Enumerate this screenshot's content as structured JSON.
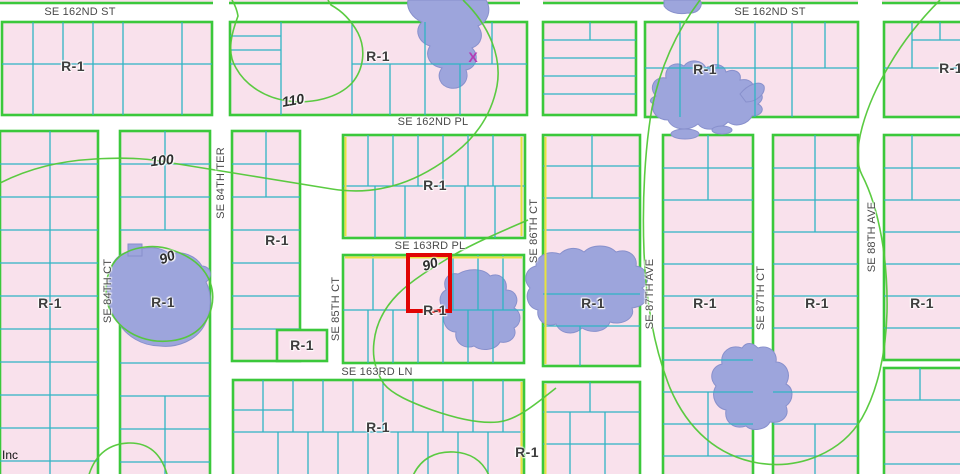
{
  "map": {
    "colors": {
      "parcel_fill": "#f9e1ec",
      "street_fill": "#ffffff",
      "block_border": "#3bc83b",
      "lot_line": "#2fb4c4",
      "contour": "#52c838",
      "water_fill": "#9da5dc",
      "water_edge": "#8890cc",
      "highlight_red": "#e00404",
      "yellow_edge": "#e8e23e",
      "x_mark": "#b43cb4",
      "label_text": "#4a4a4a"
    },
    "street_labels": [
      {
        "text": "SE 162ND ST"
      },
      {
        "text": "SE 162ND ST"
      },
      {
        "text": "SE 162ND PL"
      },
      {
        "text": "SE 163RD PL"
      },
      {
        "text": "SE 163RD LN"
      },
      {
        "text": "SE 84TH CT"
      },
      {
        "text": "SE 84TH TER"
      },
      {
        "text": "SE 85TH CT"
      },
      {
        "text": "SE 86TH CT"
      },
      {
        "text": "SE 87TH AVE"
      },
      {
        "text": "SE 87TH CT"
      },
      {
        "text": "SE 88TH AVE"
      }
    ],
    "zone_labels": [
      {
        "text": "R-1"
      },
      {
        "text": "R-1"
      },
      {
        "text": "R-1"
      },
      {
        "text": "R-1"
      },
      {
        "text": "R-1"
      },
      {
        "text": "R-1"
      },
      {
        "text": "R-1"
      },
      {
        "text": "R-1"
      },
      {
        "text": "R-1"
      },
      {
        "text": "R-1"
      },
      {
        "text": "R-1"
      },
      {
        "text": "R-1"
      },
      {
        "text": "R-1"
      },
      {
        "text": "R-1"
      },
      {
        "text": "R-1"
      },
      {
        "text": "R-1"
      }
    ],
    "contour_labels": [
      {
        "text": "110"
      },
      {
        "text": "100"
      },
      {
        "text": "90"
      },
      {
        "text": "90"
      }
    ],
    "marks": {
      "x_mark": "X"
    },
    "credit": "Inc"
  }
}
